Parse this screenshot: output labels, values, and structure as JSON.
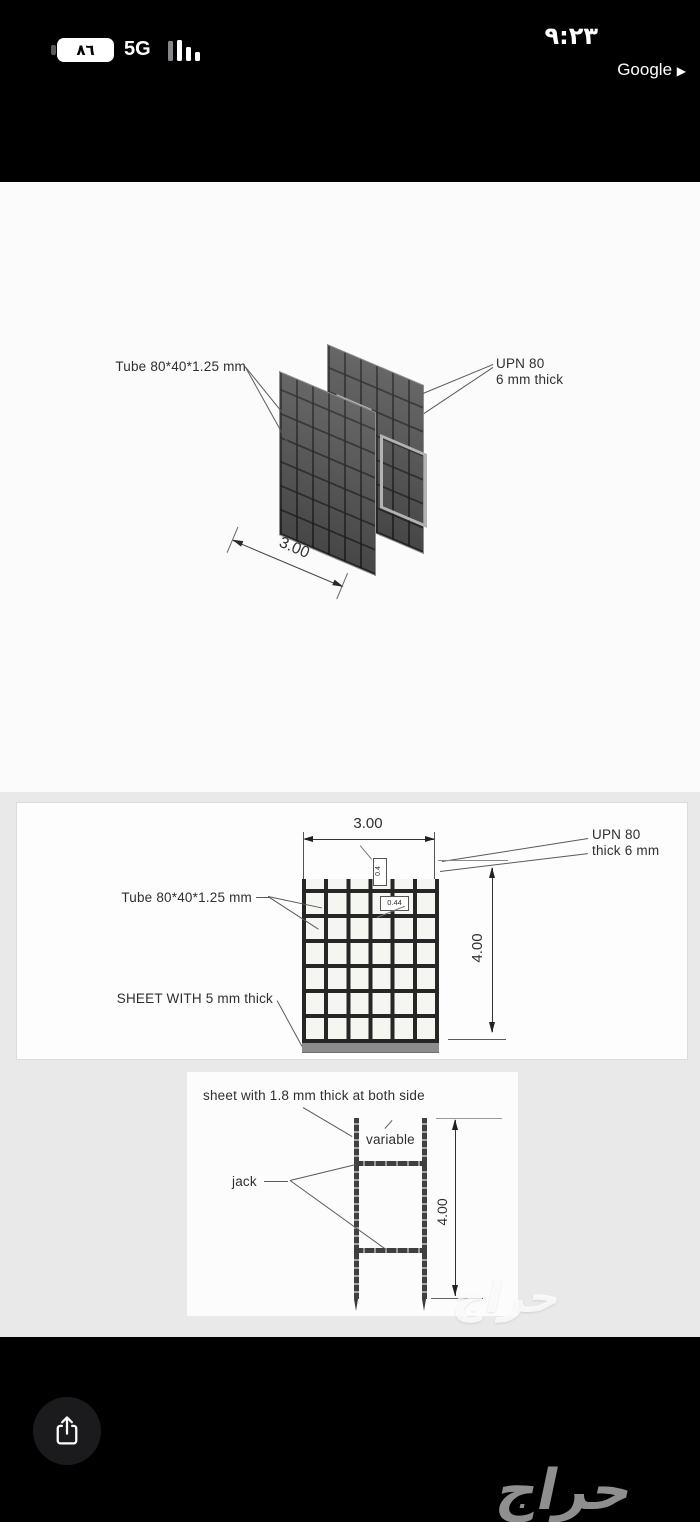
{
  "status_bar": {
    "battery_percent": "٨٦",
    "network": "5G",
    "time": "٩:٢٣",
    "back_to_app": "Google",
    "back_arrow": "▶"
  },
  "photo": {
    "iso_view": {
      "tube_label": "Tube 80*40*1.25 mm",
      "upn_label_line1": "UPN 80",
      "upn_label_line2": "6 mm thick",
      "width_dim": "3.00"
    },
    "front_view": {
      "width_dim": "3.00",
      "upn_label_line1": "UPN 80",
      "upn_label_line2": "thick 6 mm",
      "tube_label": "Tube 80*40*1.25 mm",
      "sheet_label": "SHEET WITH 5 mm thick",
      "height_dim": "4.00",
      "small_dim_vertical": "0.4",
      "small_dim_horizontal": "0.44"
    },
    "side_view": {
      "sheet_label": "sheet with 1.8 mm thick at both side",
      "variable_label": "variable",
      "jack_label": "jack",
      "height_dim": "4.00"
    }
  },
  "watermark": {
    "text": "حراج"
  },
  "icons": {
    "battery": "battery-icon",
    "signal": "signal-bars-icon",
    "share": "share-icon"
  },
  "colors": {
    "status_text": "#ffffff",
    "photo_bg": "#fbfbfb",
    "panel_gray_bg": "#e9e9e9",
    "mesh_fill": "#565656",
    "sheet_gray": "#8c8c8c",
    "watermark_gray": "#8f8f8f",
    "share_button_bg": "#1b1b1d"
  }
}
